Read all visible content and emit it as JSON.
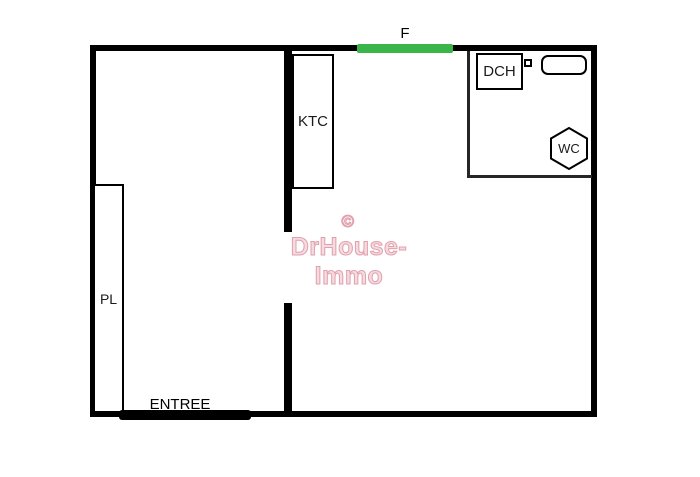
{
  "colors": {
    "wall": "#000000",
    "thin_partition": "#262626",
    "window_green": "#3ab54a",
    "watermark_pink": "#e2a0ad",
    "background": "#ffffff"
  },
  "floor_plan": {
    "window": {
      "label": "F"
    },
    "kitchenette": {
      "label": "KTC"
    },
    "shower": {
      "label": "DCH"
    },
    "toilet": {
      "label": "WC"
    },
    "closet": {
      "label": "PL"
    },
    "entrance": {
      "label": "ENTREE"
    }
  },
  "watermark": {
    "copyright_symbol": "©",
    "brand": "DrHouse-Immo"
  }
}
